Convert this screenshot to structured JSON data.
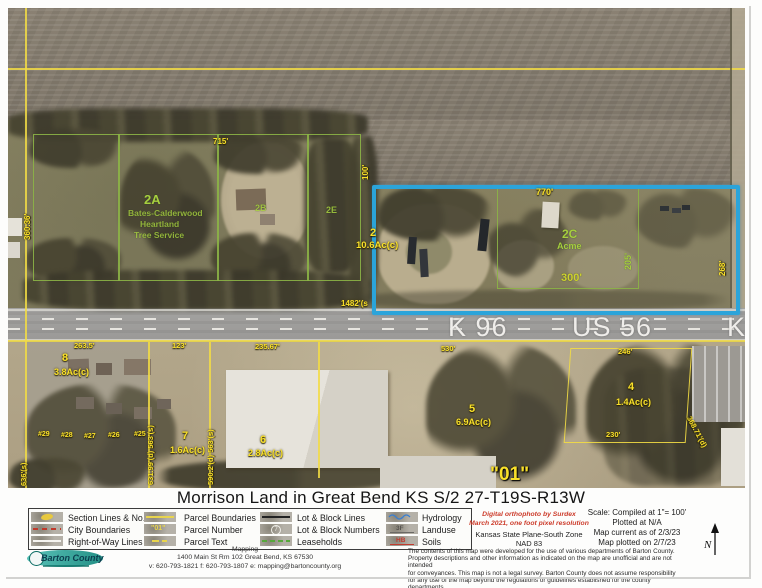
{
  "title": "Morrison Land in Great Bend KS S/2 27-T19S-R13W",
  "map": {
    "lbl": {
      "k96": "K 96",
      "us56": "US 56",
      "k2": "K",
      "p2": "2",
      "p2ac": "10.6Ac(c)",
      "p2a": "2A",
      "p2a1": "Bates-Calderwood",
      "p2a2": "Heartland",
      "p2a3": "Tree Service",
      "p2b": "2B",
      "p2e": "2E",
      "p2c": "2C",
      "acme": "Acme",
      "p8": "8",
      "p8ac": "3.8Ac(c)",
      "p7": "7",
      "p7ac": "1.6Ac(c)",
      "p6": "6",
      "p6ac": "2.8Ac(c)",
      "p5": "5",
      "p5ac": "6.9Ac(c)",
      "p4": "4",
      "p4ac": "1.4Ac(c)",
      "lot01": "\"01\"",
      "d715": "715'",
      "d36036": "360.36'",
      "d100": "100'",
      "d770": "770'",
      "d268": "268'",
      "d1482": "1482'(s",
      "d205": "205'",
      "d300": "300'",
      "d2635": "263.5'",
      "d123": "123'",
      "d23567": "235.67'",
      "d530": "530'",
      "d246": "246'",
      "d230": "230'",
      "d636": "636'(s)",
      "d631": "631.99'(d) 563'(s)",
      "d590": "590.2'(d) 563'(s)",
      "d36871": "368.71'(d)",
      "h29": "#29",
      "h28": "#28",
      "h27": "#27",
      "h26": "#26",
      "h25": "#25"
    }
  },
  "legend": {
    "col1": [
      "Section Lines & No.",
      "City Boundaries",
      "Right-of-Way Lines"
    ],
    "col2": [
      "Parcel Boundaries",
      "Parcel Number",
      "Parcel Text"
    ],
    "col3": [
      "Lot & Block Lines",
      "Lot & Block Numbers",
      "Leaseholds"
    ],
    "col4": [
      "Hydrology",
      "Landuse",
      "Soils"
    ],
    "sw_parcelnum": "\"01\"",
    "sw_lotnum": "7",
    "sw_landuse": "3F",
    "sw_soils": "HB"
  },
  "credits": {
    "ortho_line1": "Digital orthophoto by Surdex",
    "ortho_line2": "March 2021, one foot pixel resolution",
    "datum_line1": "Kansas State Plane-South Zone",
    "datum_line2": "NAD 83"
  },
  "scale_block": {
    "scale": "Scale:  Compiled at 1\"= 100'",
    "plotted": "Plotted at N/A",
    "current": "Map current as of 2/3/23",
    "plotted_on": "Map plotted on 2/7/23"
  },
  "north_label": "N",
  "disclaimer": {
    "line1": "The contents of this map were developed for the use of various departments of Barton County.",
    "line2": "Property descriptions and other information as indicated on the map are unofficial and are not intended",
    "line3": "for conveyances. This map is not a legal survey. Barton County does not assume responsibility",
    "line4": "for any use of the map beyond the regulations or guidelines established for the county departments."
  },
  "footer": {
    "logo_text": "Barton County",
    "dept": "Mapping",
    "address": "1400 Main St Rm 102 Great Bend, KS  67530",
    "contact": "v: 620-793-1821  f: 620-793-1807  e: mapping@bartoncounty.org"
  }
}
